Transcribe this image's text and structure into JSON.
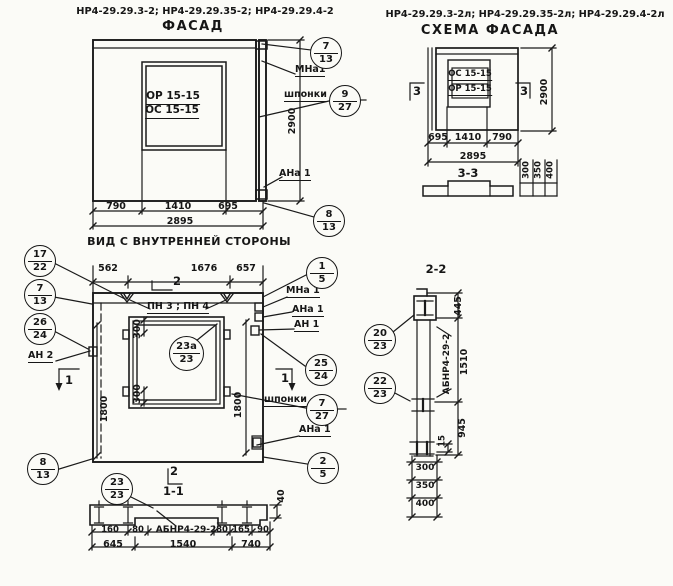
{
  "colors": {
    "ink": "#161616",
    "paper": "#fbfbf7"
  },
  "drawing": {
    "facade": {
      "title": "НР4-29.29.3-2; НР4-29.29.35-2; НР4-29.29.4-2",
      "view_name": "ФАСАД",
      "window_mark_top": "ОР 15-15",
      "window_mark_bottom": "ОС 15-15",
      "dim_left": "790",
      "dim_mid": "1410",
      "dim_right": "695",
      "dim_total": "2895",
      "dim_height": "2900",
      "label_mna1": "МНа1",
      "label_shponki": "шпонки",
      "label_ana1": "АНа 1",
      "callout_top": {
        "num": "7",
        "sheet": "13"
      },
      "callout_shponki": {
        "num": "9",
        "sheet": "27"
      },
      "callout_bottom": {
        "num": "8",
        "sheet": "13"
      }
    },
    "schema": {
      "title": "НР4-29.29.3-2л; НР4-29.29.35-2л; НР4-29.29.4-2л",
      "view_name": "СХЕМА ФАСАДА",
      "window_mark_top": "ОС 15-15",
      "window_mark_bottom": "ОР 15-15",
      "section_mark_left": "3",
      "section_mark_right": "3",
      "dim_left": "695",
      "dim_mid": "1410",
      "dim_right": "790",
      "dim_total": "2895",
      "dim_height": "2900",
      "section_3_3": {
        "title": "3-3",
        "dim_1": "300",
        "dim_2": "350",
        "dim_3": "400"
      }
    },
    "inner_view": {
      "title": "ВИД С ВНУТРЕННЕЙ СТОРОНЫ",
      "dim_top_left": "562",
      "dim_top_mid": "1676",
      "dim_top_right": "657",
      "label_pn": "ПН 3 ; ПН 4",
      "dim_window_top": "300",
      "dim_window_bottom": "300",
      "dim_height_left": "1800",
      "dim_height_right": "1800",
      "section_mark_2": "2",
      "section_mark_1_left": "1",
      "section_mark_1_right": "1",
      "label_an2": "АН 2",
      "label_mna1": "МНа 1",
      "label_ana1": "АНа 1",
      "label_an1": "АН 1",
      "label_shponki": "шпонки",
      "label_ana1_bottom": "АНа 1",
      "callout_17_22": {
        "num": "17",
        "sheet": "22"
      },
      "callout_7_13": {
        "num": "7",
        "sheet": "13"
      },
      "callout_26_24": {
        "num": "26",
        "sheet": "24"
      },
      "callout_8_13": {
        "num": "8",
        "sheet": "13"
      },
      "callout_1_5": {
        "num": "1",
        "sheet": "5"
      },
      "callout_25_24": {
        "num": "25",
        "sheet": "24"
      },
      "callout_shponki": {
        "num": "7",
        "sheet": "27"
      },
      "callout_2_5": {
        "num": "2",
        "sheet": "5"
      },
      "callout_23a_23": {
        "num": "23а",
        "sheet": "23"
      }
    },
    "section_1_1": {
      "mark": "2",
      "title": "1-1",
      "callout_23_23": {
        "num": "23",
        "sheet": "23"
      },
      "label_block": "АБНР4-29-2",
      "dim_160": "160",
      "dim_80_left": "80",
      "dim_80_right": "80",
      "dim_165": "165",
      "dim_90": "90",
      "dim_645": "645",
      "dim_1540": "1540",
      "dim_740": "740",
      "dim_40": "40"
    },
    "section_2_2": {
      "title": "2-2",
      "label_block": "АБНР4-29-2",
      "dim_445": "445",
      "dim_1510": "1510",
      "dim_945": "945",
      "dim_15": "15",
      "dim_300": "300",
      "dim_350": "350",
      "dim_400": "400",
      "callout_20_23": {
        "num": "20",
        "sheet": "23"
      },
      "callout_22_23": {
        "num": "22",
        "sheet": "23"
      }
    }
  }
}
